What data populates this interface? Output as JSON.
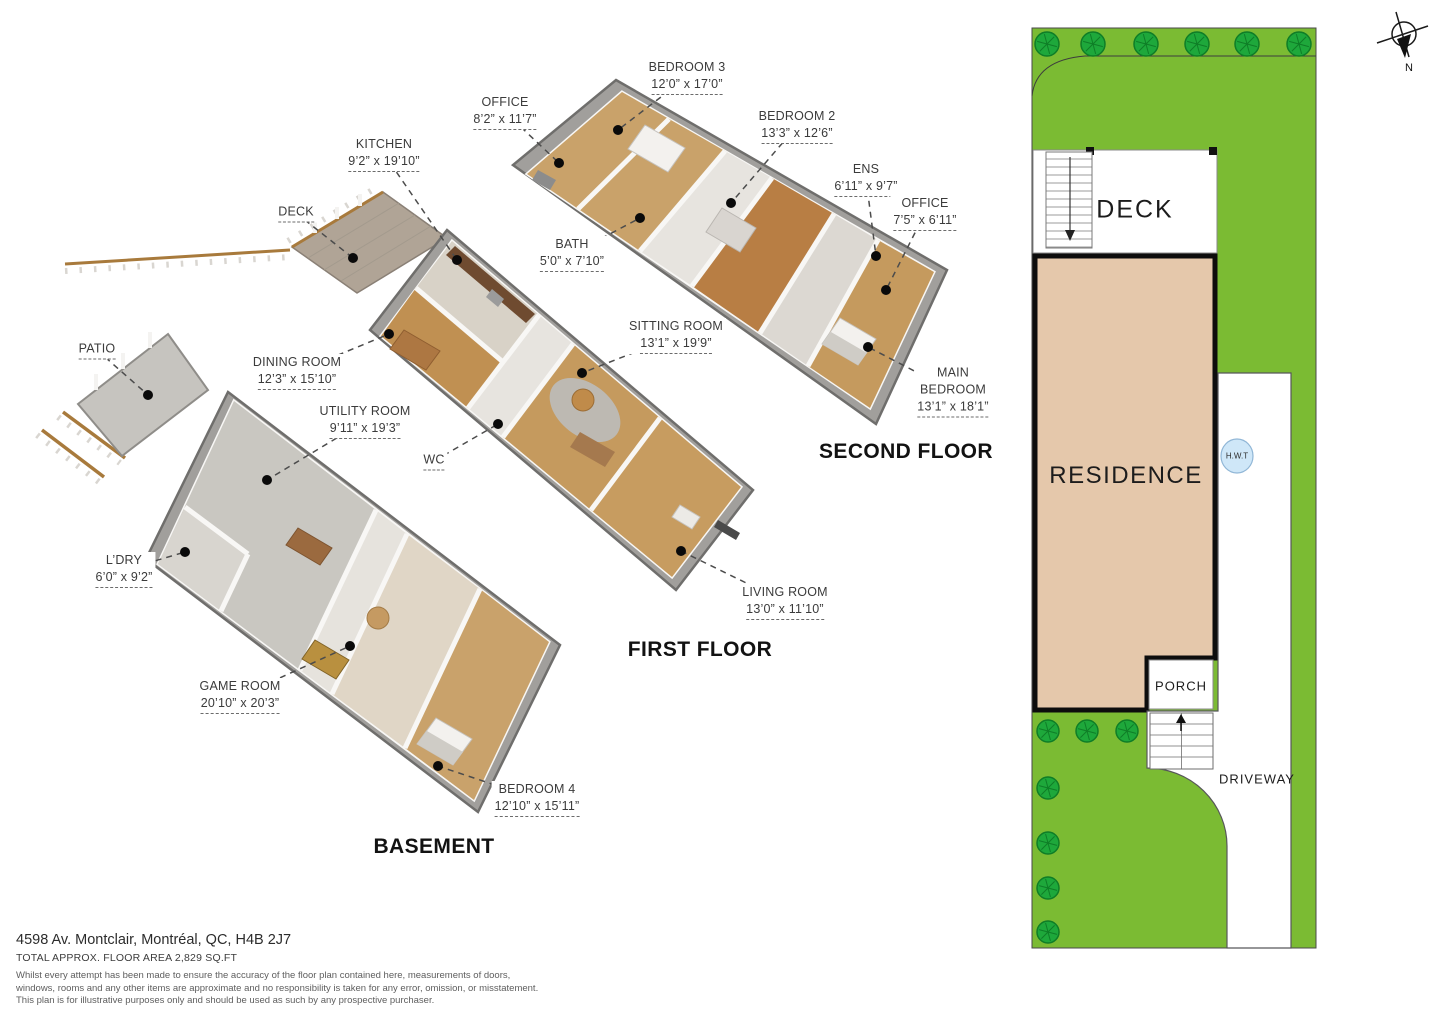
{
  "address": {
    "line1": "4598 Av. Montclair, Montréal, QC, H4B 2J7",
    "line2": "TOTAL APPROX. FLOOR AREA 2,829 SQ.FT",
    "disclaimer1": "Whilst every attempt has been made to ensure the accuracy of the floor plan contained here, measurements of doors,",
    "disclaimer2": "windows, rooms and any other items are approximate and no responsibility is taken for any error, omission, or misstatement.",
    "disclaimer3": "This plan is for illustrative purposes only and should be used as such by any prospective purchaser."
  },
  "floors": [
    {
      "id": "second",
      "title": "SECOND FLOOR",
      "rooms": [
        {
          "name": "BEDROOM 3",
          "dims": "12’0” x 17’0”",
          "x": 687,
          "y": 77,
          "dot_x": 618,
          "dot_y": 130
        },
        {
          "name": "OFFICE",
          "dims": "8’2” x 11’7”",
          "x": 505,
          "y": 112,
          "dot_x": 559,
          "dot_y": 163
        },
        {
          "name": "BEDROOM 2",
          "dims": "13’3” x 12’6”",
          "x": 797,
          "y": 126,
          "dot_x": 731,
          "dot_y": 203
        },
        {
          "name": "ENS",
          "dims": "6’11” x 9’7”",
          "x": 866,
          "y": 179,
          "dot_x": 876,
          "dot_y": 256
        },
        {
          "name": "OFFICE",
          "dims": "7’5” x 6’11”",
          "x": 925,
          "y": 213,
          "dot_x": 886,
          "dot_y": 290
        },
        {
          "name": "BATH",
          "dims": "5’0” x 7’10”",
          "x": 572,
          "y": 254,
          "dot_x": 640,
          "dot_y": 218
        },
        {
          "name": "MAIN\nBEDROOM",
          "dims": "13’1” x 18’1”",
          "x": 953,
          "y": 391,
          "dot_x": 868,
          "dot_y": 347
        }
      ]
    },
    {
      "id": "first",
      "title": "FIRST FLOOR",
      "rooms": [
        {
          "name": "KITCHEN",
          "dims": "9’2” x 19’10”",
          "x": 384,
          "y": 154,
          "dot_x": 457,
          "dot_y": 260
        },
        {
          "name": "DECK",
          "dims": "",
          "x": 296,
          "y": 213,
          "dot_x": 353,
          "dot_y": 258
        },
        {
          "name": "SITTING ROOM",
          "dims": "13’1” x 19’9”",
          "x": 676,
          "y": 336,
          "dot_x": 582,
          "dot_y": 373
        },
        {
          "name": "DINING ROOM",
          "dims": "12’3” x 15’10”",
          "x": 297,
          "y": 372,
          "dot_x": 389,
          "dot_y": 334
        },
        {
          "name": "WC",
          "dims": "",
          "x": 434,
          "y": 461,
          "dot_x": 498,
          "dot_y": 424
        },
        {
          "name": "LIVING ROOM",
          "dims": "13’0” x 11’10”",
          "x": 785,
          "y": 602,
          "dot_x": 681,
          "dot_y": 551
        }
      ]
    },
    {
      "id": "basement",
      "title": "BASEMENT",
      "rooms": [
        {
          "name": "PATIO",
          "dims": "",
          "x": 97,
          "y": 350,
          "dot_x": 148,
          "dot_y": 395
        },
        {
          "name": "UTILITY ROOM",
          "dims": "9’11” x 19’3”",
          "x": 365,
          "y": 421,
          "dot_x": 267,
          "dot_y": 480
        },
        {
          "name": "L’DRY",
          "dims": "6’0” x 9’2”",
          "x": 124,
          "y": 570,
          "dot_x": 185,
          "dot_y": 552
        },
        {
          "name": "GAME ROOM",
          "dims": "20’10” x 20’3”",
          "x": 240,
          "y": 696,
          "dot_x": 350,
          "dot_y": 646
        },
        {
          "name": "BEDROOM 4",
          "dims": "12’10” x 15’11”",
          "x": 537,
          "y": 799,
          "dot_x": 438,
          "dot_y": 766
        }
      ]
    }
  ],
  "site": {
    "labels": {
      "deck": "DECK",
      "residence": "RESIDENCE",
      "porch": "PORCH",
      "driveway": "DRIVEWAY",
      "hwt": "H.W.T",
      "compass_n": "N"
    },
    "colors": {
      "grass": "#7bbb33",
      "tree": "#1ea83b",
      "tree_dark": "#0f7d27",
      "residence_fill": "#e5c8ab",
      "hwt_fill": "#cfe7f8",
      "leader": "#4c4c4c"
    },
    "trees_top": [
      [
        1047,
        44
      ],
      [
        1093,
        44
      ],
      [
        1146,
        44
      ],
      [
        1197,
        44
      ],
      [
        1247,
        44
      ],
      [
        1299,
        44
      ]
    ],
    "trees_side": [
      [
        1048,
        731
      ],
      [
        1087,
        731
      ],
      [
        1127,
        731
      ],
      [
        1048,
        788
      ],
      [
        1048,
        843
      ],
      [
        1048,
        888
      ],
      [
        1048,
        932
      ]
    ]
  }
}
